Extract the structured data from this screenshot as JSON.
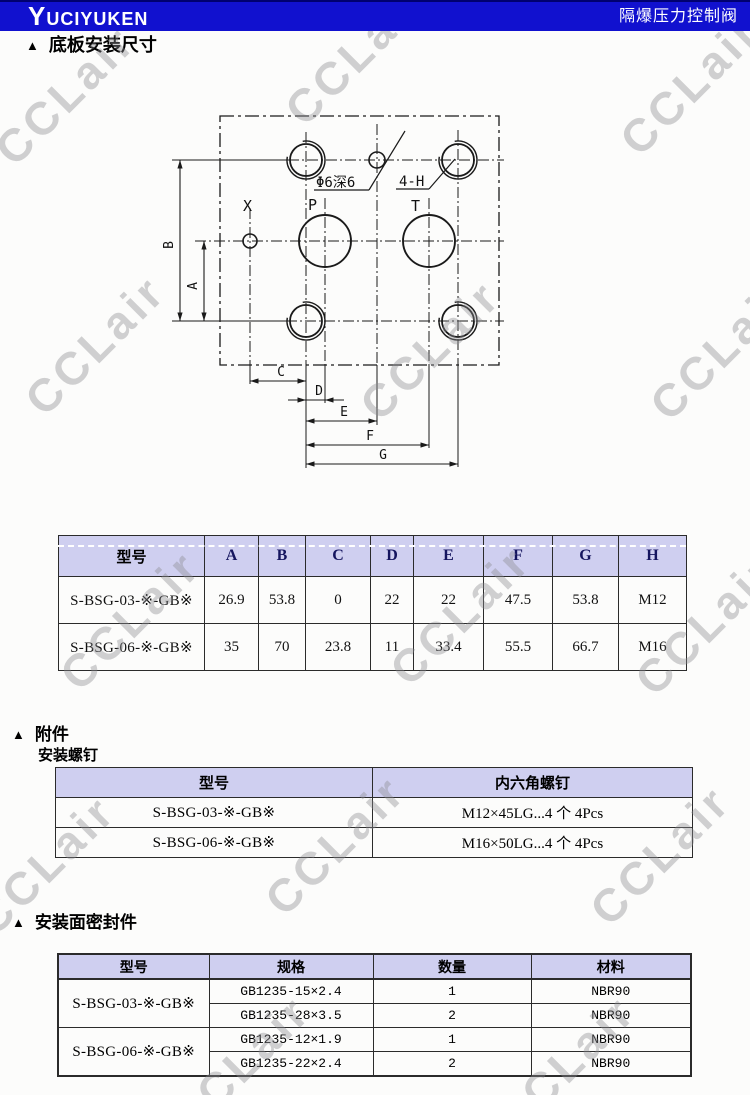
{
  "header": {
    "logo": "YUCIYUKEN",
    "title": "隔爆压力控制阀",
    "bar_color": "#1111cf"
  },
  "watermark": {
    "text": "CCLair"
  },
  "colors": {
    "accent_blue": "#1111cf",
    "table_header_lavender": "#cfcff0",
    "watermark_gray": "#8d8d92"
  },
  "sections": {
    "s1": {
      "marker": "▲",
      "title": "底板安装尺寸"
    },
    "s2": {
      "marker": "▲",
      "title": "附件",
      "subtitle": "安装螺钉"
    },
    "s3": {
      "marker": "▲",
      "title": "安装面密封件"
    }
  },
  "drawing": {
    "labels": {
      "hole_note": "Φ6深6",
      "bolt_note": "4-H",
      "port_x": "X",
      "port_p": "P",
      "port_t": "T",
      "dim_a": "A",
      "dim_b": "B",
      "dim_c": "C",
      "dim_d": "D",
      "dim_e": "E",
      "dim_f": "F",
      "dim_g": "G"
    }
  },
  "dim_table": {
    "headers": [
      "型号",
      "A",
      "B",
      "C",
      "D",
      "E",
      "F",
      "G",
      "H"
    ],
    "rows": [
      {
        "model": "S-BSG-03-※-GB※",
        "values": [
          "26.9",
          "53.8",
          "0",
          "22",
          "22",
          "47.5",
          "53.8",
          "M12"
        ]
      },
      {
        "model": "S-BSG-06-※-GB※",
        "values": [
          "35",
          "70",
          "23.8",
          "11",
          "33.4",
          "55.5",
          "66.7",
          "M16"
        ]
      }
    ]
  },
  "screw_table": {
    "headers": [
      "型号",
      "内六角螺钉"
    ],
    "rows": [
      {
        "model": "S-BSG-03-※-GB※",
        "screw": "M12×45LG...4 个 4Pcs"
      },
      {
        "model": "S-BSG-06-※-GB※",
        "screw": "M16×50LG...4 个 4Pcs"
      }
    ]
  },
  "seal_table": {
    "headers": [
      "型号",
      "规格",
      "数量",
      "材料"
    ],
    "groups": [
      {
        "model": "S-BSG-03-※-GB※",
        "rows": [
          [
            "GB1235-15×2.4",
            "1",
            "NBR90"
          ],
          [
            "GB1235-28×3.5",
            "2",
            "NBR90"
          ]
        ]
      },
      {
        "model": "S-BSG-06-※-GB※",
        "rows": [
          [
            "GB1235-12×1.9",
            "1",
            "NBR90"
          ],
          [
            "GB1235-22×2.4",
            "2",
            "NBR90"
          ]
        ]
      }
    ]
  }
}
